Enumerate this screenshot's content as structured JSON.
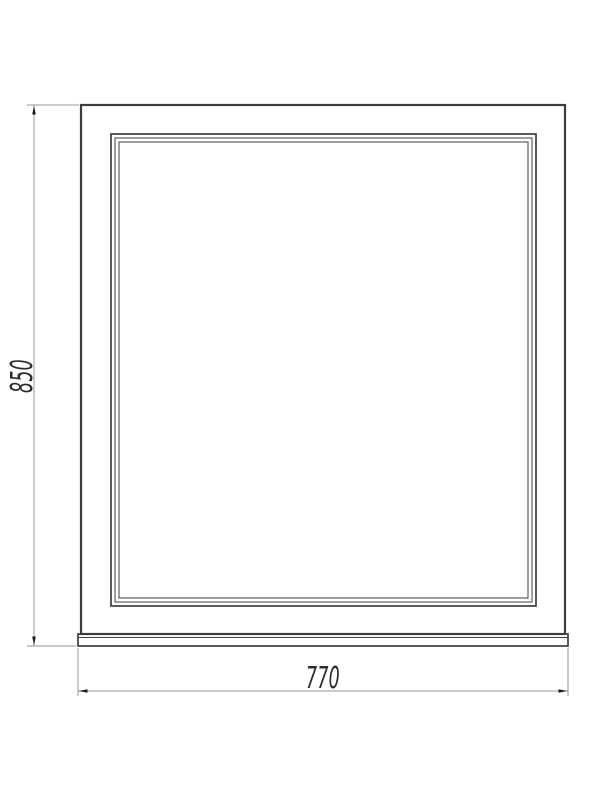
{
  "drawing": {
    "dimensions": {
      "height_label": "850",
      "width_label": "770"
    },
    "colors": {
      "background": "#ffffff",
      "object_line": "#3d3d3d",
      "thin_line": "#4a4a4a",
      "dimension_line": "#979797",
      "arrow": "#1c1c1c",
      "text": "#2b2b2b"
    }
  }
}
